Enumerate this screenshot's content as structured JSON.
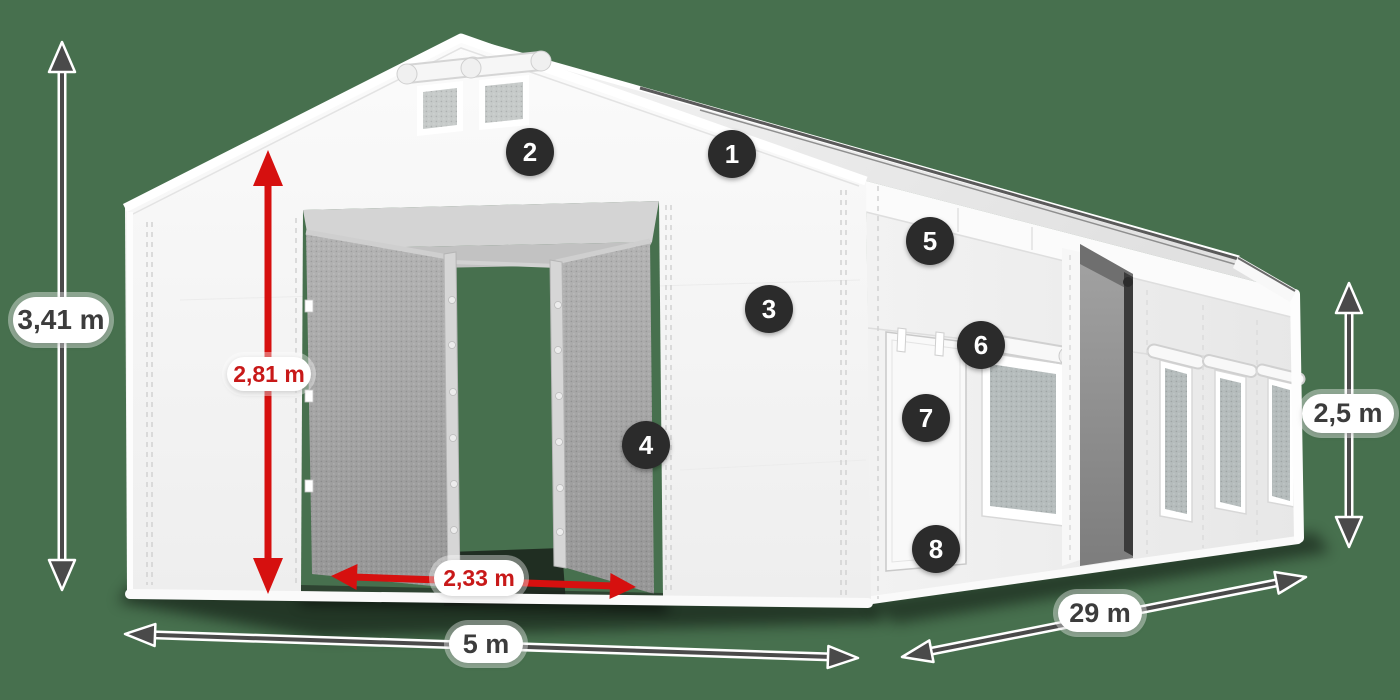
{
  "measurements": {
    "total_height": {
      "label": "3,41 m",
      "style": "gray"
    },
    "entrance_height": {
      "label": "2,81 m",
      "style": "red"
    },
    "entrance_width": {
      "label": "2,33 m",
      "style": "red"
    },
    "front_width": {
      "label": "5 m",
      "style": "gray"
    },
    "side_length": {
      "label": "29 m",
      "style": "gray"
    },
    "side_height": {
      "label": "2,5 m",
      "style": "gray"
    }
  },
  "feature_badges": [
    {
      "number": "1"
    },
    {
      "number": "2"
    },
    {
      "number": "3"
    },
    {
      "number": "4"
    },
    {
      "number": "5"
    },
    {
      "number": "6"
    },
    {
      "number": "7"
    },
    {
      "number": "8"
    }
  ],
  "colors": {
    "background": "#47704e",
    "dimension_red": "#d6100f",
    "dimension_gray": "#4a4a4a",
    "label_text_dark": "#3c3c3c",
    "label_text_red": "#c81919",
    "badge_background": "#2b2b2b",
    "badge_text": "#ffffff",
    "tent_white": "#f5f5f5",
    "mesh_gray": "#a8a8a8"
  }
}
